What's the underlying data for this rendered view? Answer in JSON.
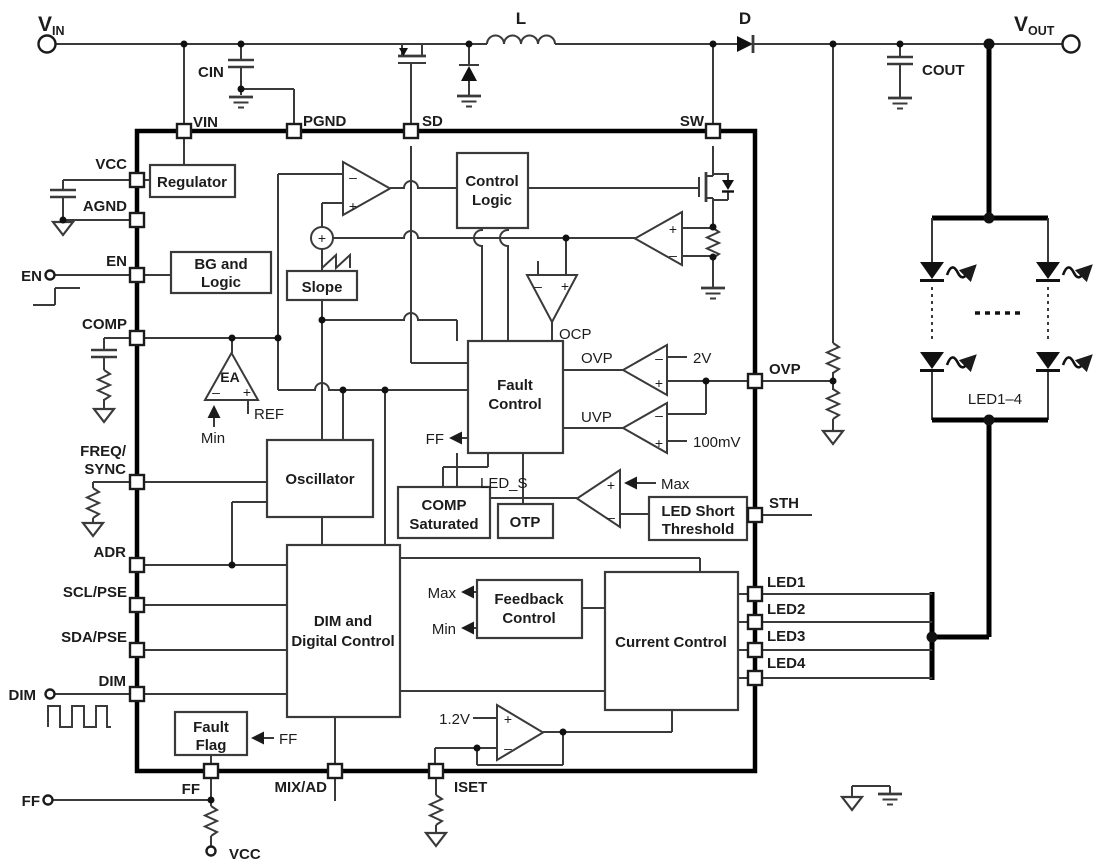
{
  "power": {
    "vin": "V",
    "vin_sub": "IN",
    "vout": "V",
    "vout_sub": "OUT",
    "inductor": "L",
    "diode": "D",
    "input_cap": "CIN",
    "output_cap": "COUT"
  },
  "pins": {
    "vin": "VIN",
    "pgnd": "PGND",
    "sd": "SD",
    "sw": "SW",
    "vcc": "VCC",
    "agnd": "AGND",
    "en": "EN",
    "comp": "COMP",
    "freq_line1": "FREQ/",
    "freq_line2": "SYNC",
    "adr": "ADR",
    "scl_pse": "SCL/PSE",
    "sda_pse": "SDA/PSE",
    "dim": "DIM",
    "ovp": "OVP",
    "sth": "STH",
    "led1": "LED1",
    "led2": "LED2",
    "led3": "LED3",
    "led4": "LED4",
    "ff": "FF",
    "mix_ad": "MIX/AD",
    "iset": "ISET"
  },
  "external": {
    "en": "EN",
    "dim": "DIM",
    "ff": "FF",
    "vcc_pullup": "VCC",
    "led_array": "LED1–4"
  },
  "blocks": {
    "regulator": "Regulator",
    "bg_line1": "BG and",
    "bg_line2": "Logic",
    "slope": "Slope",
    "control_line1": "Control",
    "control_line2": "Logic",
    "oscillator": "Oscillator",
    "fault_line1": "Fault",
    "fault_line2": "Control",
    "comp_sat_line1": "COMP",
    "comp_sat_line2": "Saturated",
    "otp": "OTP",
    "led_short_line1": "LED Short",
    "led_short_line2": "Threshold",
    "dim_line1": "DIM and",
    "dim_line2": "Digital Control",
    "feedback_line1": "Feedback",
    "feedback_line2": "Control",
    "current_control": "Current Control",
    "fault_flag_line1": "Fault",
    "fault_flag_line2": "Flag"
  },
  "signals": {
    "ea": "EA",
    "ref": "REF",
    "min": "Min",
    "max": "Max",
    "ocp": "OCP",
    "ovp": "OVP",
    "uvp": "UVP",
    "ovp_ref": "2V",
    "uvp_ref": "100mV",
    "led_s": "LED_S",
    "ff": "FF",
    "iset_ref": "1.2V"
  },
  "symbols": {
    "plus": "+",
    "minus": "–"
  }
}
